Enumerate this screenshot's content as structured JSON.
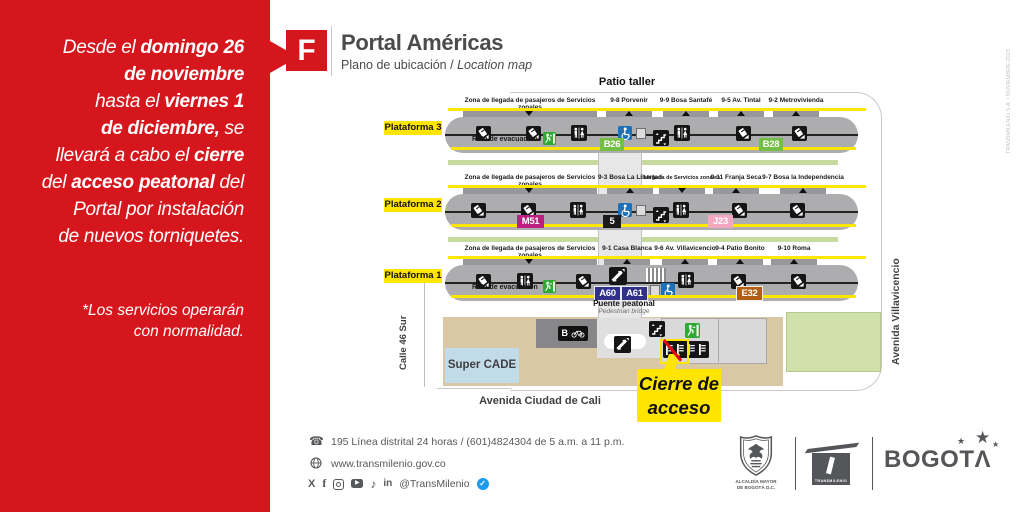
{
  "notice": {
    "lines": [
      [
        "Desde el ",
        "domingo 26"
      ],
      [
        "de noviembre"
      ],
      [
        "hasta el ",
        "viernes 1"
      ],
      [
        "de diciembre,",
        " se"
      ],
      [
        "llevará a cabo el ",
        "cierre"
      ],
      [
        "del ",
        "acceso peatonal",
        " del"
      ],
      [
        "Portal por instalación"
      ],
      [
        "de nuevos torniquetes."
      ]
    ],
    "note": [
      "*Los servicios operarán",
      "con normalidad."
    ]
  },
  "header": {
    "letter": "F",
    "title": "Portal Américas",
    "subtitle": "Plano de ubicación / ",
    "subtitle_italic": "Location map"
  },
  "map": {
    "patio": "Patio taller",
    "labels": {
      "zona": "Zona de llegada de pasajeros de Servicios zonales",
      "llegada": "Llegada de Servicios zonales",
      "ruta": "Ruta de evacuación"
    },
    "platforms": [
      {
        "label": "Plataforma 3",
        "stations": [
          "9-8 Porvenir",
          "9-9 Bosa Santafé",
          "9-5 Av. Tintal",
          "9-2 Metrovivienda"
        ],
        "routes": [
          "B26",
          "B28"
        ]
      },
      {
        "label": "Plataforma 2",
        "stations": [
          "9-3 Bosa La Libertad",
          "9-11 Franja Seca",
          "9-7 Bosa la Independencia"
        ],
        "routes": [
          "M51",
          "5",
          "J23"
        ]
      },
      {
        "label": "Plataforma 1",
        "stations": [
          "9-1 Casa Blanca",
          "9-6 Av. Villavicencio",
          "9-4 Patio Bonito",
          "9-10 Roma"
        ],
        "routes": [
          "A60",
          "A61",
          "E32"
        ]
      }
    ],
    "bridge": {
      "es": "Puente peatonal",
      "en": "Pedestrian bridge"
    },
    "super_cade": "Super CADE",
    "closure": {
      "line1": "Cierre de",
      "line2": "acceso"
    },
    "streets": {
      "left": "Calle 46 Sur",
      "right": "Avenida Villavicencio",
      "bottom": "Avenida Ciudad de Cali"
    },
    "bike_badge": "B"
  },
  "footer": {
    "phone": "195 Línea distrital 24 horas / (601)4824304 de 5 a.m. a 11 p.m.",
    "website": "www.transmilenio.gov.co",
    "handle": "@TransMilenio",
    "social": {
      "x": "X",
      "facebook": "f",
      "youtube_glyph": "▶",
      "tiktok_glyph": "♪",
      "linkedin": "in",
      "verified_glyph": "✓"
    }
  },
  "logos": {
    "alcaldia_line1": "ALCALDÍA MAYOR",
    "alcaldia_line2": "DE BOGOTÁ D.C.",
    "transmilenio": "TRANSMILENIO",
    "bogota_word": "BOGOT",
    "bogota_a": "Λ",
    "bogota_star": "★"
  },
  "edge_note": "TRANSMILENIO S.A. / NOVIEMBRE-2023",
  "colors": {
    "brand_red": "#D5161D",
    "highlight_yellow": "#FFE500",
    "platform_gray": "#ADADB0",
    "route_green": "#72BF44",
    "route_magenta": "#BB1F7F",
    "route_pink": "#F3A8C0",
    "route_blue": "#303089",
    "route_brown": "#B05E13",
    "route_black": "#1A1A1A",
    "wheelchair_blue": "#1D71B8",
    "exit_green": "#2FA836",
    "tan_area": "#DAC7A4",
    "green_area": "#CFE0AB",
    "supercade_blue": "#C2DBE8"
  }
}
